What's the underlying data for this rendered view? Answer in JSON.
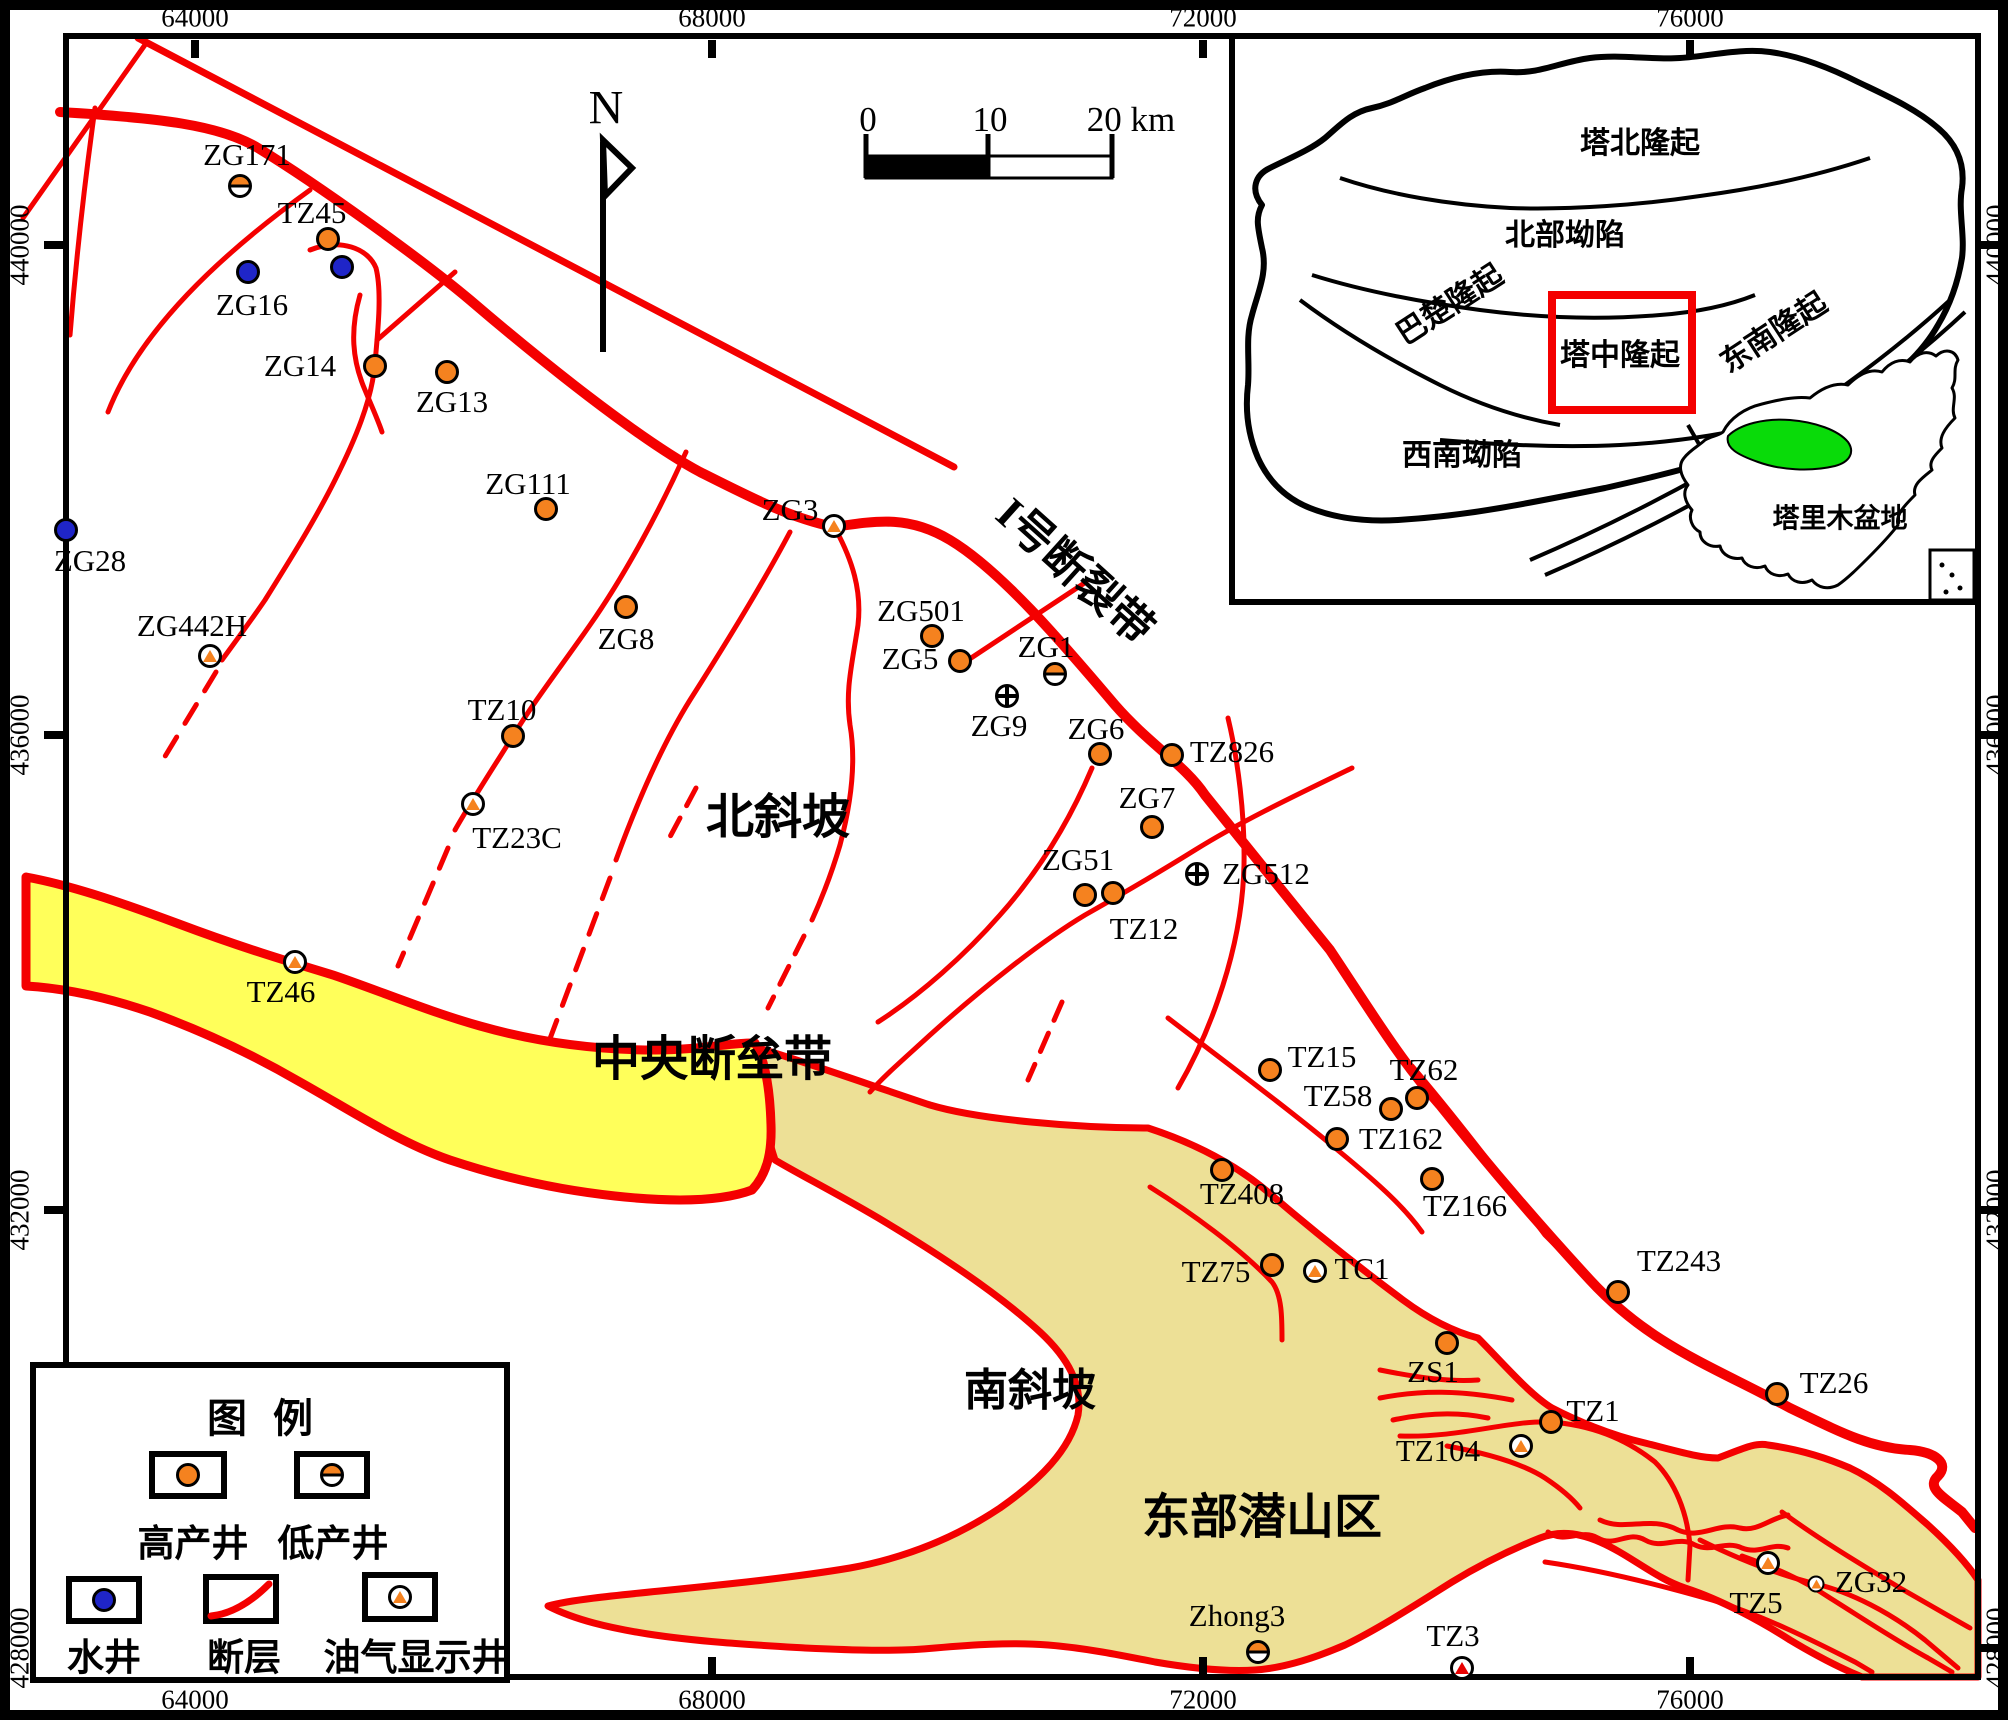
{
  "colors": {
    "fault_red": "#F40000",
    "high_yield_orange": "#F5821F",
    "water_blue": "#1F25C8",
    "central_horst_yellow": "#FFFF5A",
    "buried_hill_khaki": "#EDE096",
    "tarim_green": "#09DB09"
  },
  "north": {
    "label": "N"
  },
  "scalebar": {
    "zero": "0",
    "ten": "10",
    "twenty": "20 km"
  },
  "axes": {
    "top": [
      {
        "label": "64000",
        "x": 195
      },
      {
        "label": "68000",
        "x": 712
      },
      {
        "label": "72000",
        "x": 1203
      },
      {
        "label": "76000",
        "x": 1690
      }
    ],
    "bottom": [
      {
        "label": "64000",
        "x": 195
      },
      {
        "label": "68000",
        "x": 712
      },
      {
        "label": "72000",
        "x": 1203
      },
      {
        "label": "76000",
        "x": 1690
      }
    ],
    "left": [
      {
        "label": "440000",
        "y": 245
      },
      {
        "label": "436000",
        "y": 735
      },
      {
        "label": "432000",
        "y": 1210
      },
      {
        "label": "428000",
        "y": 1648
      }
    ],
    "right": [
      {
        "label": "440000",
        "y": 245
      },
      {
        "label": "436000",
        "y": 735
      },
      {
        "label": "432000",
        "y": 1210
      },
      {
        "label": "428000",
        "y": 1648
      }
    ]
  },
  "regions": [
    {
      "text": "I号断裂带",
      "x": 1078,
      "y": 568,
      "size": 44,
      "rot": 42
    },
    {
      "text": "北斜坡",
      "x": 778,
      "y": 812,
      "size": 48,
      "rot": 0
    },
    {
      "text": "中央断垒带",
      "x": 712,
      "y": 1054,
      "size": 48,
      "rot": 0
    },
    {
      "text": "南斜坡",
      "x": 1030,
      "y": 1386,
      "size": 44,
      "rot": 0
    },
    {
      "text": "东部潜山区",
      "x": 1262,
      "y": 1512,
      "size": 48,
      "rot": 0
    }
  ],
  "wells": [
    {
      "n": "ZG171",
      "t": "low",
      "x": 240,
      "y": 186,
      "lx": 247,
      "ly": 155
    },
    {
      "n": "TZ45",
      "t": "high",
      "x": 328,
      "y": 239,
      "lx": 312,
      "ly": 213
    },
    {
      "n": "",
      "t": "water",
      "x": 342,
      "y": 267,
      "lx": 0,
      "ly": 0
    },
    {
      "n": "ZG16",
      "t": "water",
      "x": 248,
      "y": 272,
      "lx": 252,
      "ly": 305
    },
    {
      "n": "ZG14",
      "t": "high",
      "x": 375,
      "y": 366,
      "lx": 300,
      "ly": 366
    },
    {
      "n": "ZG13",
      "t": "high",
      "x": 447,
      "y": 372,
      "lx": 452,
      "ly": 402
    },
    {
      "n": "ZG28",
      "t": "water",
      "x": 66,
      "y": 530,
      "lx": 90,
      "ly": 561
    },
    {
      "n": "ZG442H",
      "t": "show",
      "x": 210,
      "y": 656,
      "lx": 192,
      "ly": 626
    },
    {
      "n": "ZG111",
      "t": "high",
      "x": 546,
      "y": 509,
      "lx": 528,
      "ly": 484
    },
    {
      "n": "ZG8",
      "t": "high",
      "x": 626,
      "y": 607,
      "lx": 626,
      "ly": 639
    },
    {
      "n": "TZ10",
      "t": "high",
      "x": 513,
      "y": 736,
      "lx": 502,
      "ly": 710
    },
    {
      "n": "TZ23C",
      "t": "show",
      "x": 473,
      "y": 804,
      "lx": 517,
      "ly": 838
    },
    {
      "n": "ZG3",
      "t": "show",
      "x": 834,
      "y": 526,
      "lx": 790,
      "ly": 510
    },
    {
      "n": "ZG501",
      "t": "high",
      "x": 932,
      "y": 636,
      "lx": 921,
      "ly": 611
    },
    {
      "n": "ZG5",
      "t": "high",
      "x": 960,
      "y": 661,
      "lx": 910,
      "ly": 659
    },
    {
      "n": "ZG1",
      "t": "low",
      "x": 1055,
      "y": 674,
      "lx": 1046,
      "ly": 647
    },
    {
      "n": "ZG9",
      "t": "cross",
      "x": 1007,
      "y": 696,
      "lx": 999,
      "ly": 726
    },
    {
      "n": "ZG6",
      "t": "high",
      "x": 1100,
      "y": 754,
      "lx": 1096,
      "ly": 729
    },
    {
      "n": "TZ826",
      "t": "high",
      "x": 1172,
      "y": 755,
      "lx": 1232,
      "ly": 752
    },
    {
      "n": "ZG7",
      "t": "high",
      "x": 1152,
      "y": 827,
      "lx": 1147,
      "ly": 798
    },
    {
      "n": "ZG51",
      "t": "high",
      "x": 1085,
      "y": 895,
      "lx": 1078,
      "ly": 860
    },
    {
      "n": "TZ12",
      "t": "high",
      "x": 1113,
      "y": 893,
      "lx": 1144,
      "ly": 929
    },
    {
      "n": "ZG512",
      "t": "cross",
      "x": 1197,
      "y": 874,
      "lx": 1266,
      "ly": 874
    },
    {
      "n": "TZ46",
      "t": "show",
      "x": 295,
      "y": 962,
      "lx": 281,
      "ly": 992
    },
    {
      "n": "TZ15",
      "t": "high",
      "x": 1270,
      "y": 1070,
      "lx": 1322,
      "ly": 1057
    },
    {
      "n": "TZ62",
      "t": "high",
      "x": 1417,
      "y": 1098,
      "lx": 1424,
      "ly": 1070
    },
    {
      "n": "TZ58",
      "t": "high",
      "x": 1391,
      "y": 1109,
      "lx": 1338,
      "ly": 1096
    },
    {
      "n": "TZ162",
      "t": "high",
      "x": 1337,
      "y": 1139,
      "lx": 1401,
      "ly": 1139
    },
    {
      "n": "TZ166",
      "t": "high",
      "x": 1432,
      "y": 1179,
      "lx": 1465,
      "ly": 1206
    },
    {
      "n": "TZ408",
      "t": "high",
      "x": 1222,
      "y": 1170,
      "lx": 1242,
      "ly": 1194
    },
    {
      "n": "TZ75",
      "t": "high",
      "x": 1272,
      "y": 1265,
      "lx": 1216,
      "ly": 1272
    },
    {
      "n": "TC1",
      "t": "show",
      "x": 1315,
      "y": 1271,
      "lx": 1362,
      "ly": 1269
    },
    {
      "n": "TZ243",
      "t": "high",
      "x": 1618,
      "y": 1292,
      "lx": 1679,
      "ly": 1261
    },
    {
      "n": "ZS1",
      "t": "high",
      "x": 1447,
      "y": 1343,
      "lx": 1433,
      "ly": 1372
    },
    {
      "n": "TZ26",
      "t": "high",
      "x": 1777,
      "y": 1394,
      "lx": 1834,
      "ly": 1383
    },
    {
      "n": "TZ1",
      "t": "high",
      "x": 1551,
      "y": 1422,
      "lx": 1593,
      "ly": 1411
    },
    {
      "n": "TZ104",
      "t": "show",
      "x": 1521,
      "y": 1446,
      "lx": 1438,
      "ly": 1451
    },
    {
      "n": "Zhong3",
      "t": "low",
      "x": 1258,
      "y": 1652,
      "lx": 1237,
      "ly": 1616
    },
    {
      "n": "TZ3",
      "t": "redshow",
      "x": 1462,
      "y": 1668,
      "lx": 1453,
      "ly": 1636
    },
    {
      "n": "TZ5",
      "t": "show",
      "x": 1768,
      "y": 1563,
      "lx": 1756,
      "ly": 1603
    },
    {
      "n": "ZG32",
      "t": "showsm",
      "x": 1816,
      "y": 1584,
      "lx": 1871,
      "ly": 1582
    }
  ],
  "legend": {
    "title": "图 例",
    "items": [
      {
        "label": "高产井",
        "type": "high"
      },
      {
        "label": "低产井",
        "type": "low"
      },
      {
        "label": "水井",
        "type": "water"
      },
      {
        "label": "断层",
        "type": "fault"
      },
      {
        "label": "油气显示井",
        "type": "show"
      }
    ]
  },
  "inset": {
    "units": {
      "tabei": "塔北隆起",
      "beibu": "北部坳陷",
      "bachu": "巴楚隆起",
      "tazhong": "塔中隆起",
      "dongnan": "东南隆起",
      "xinan": "西南坳陷"
    },
    "basin_label": "塔里木盆地"
  }
}
